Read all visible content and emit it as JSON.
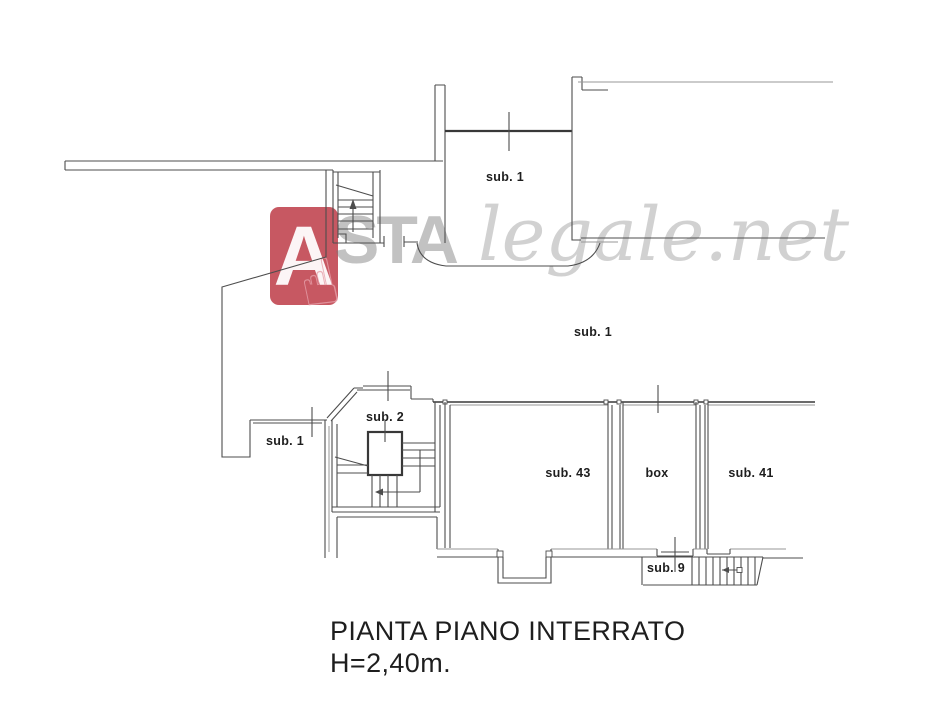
{
  "page": {
    "background": "#ffffff"
  },
  "watermark": {
    "logo_letter": "A",
    "brand_bold": "STA",
    "brand_italic": "legale.net",
    "hand_icon": "☝"
  },
  "rooms": [
    {
      "id": "sub1-top",
      "label": "sub. 1"
    },
    {
      "id": "sub1-middle",
      "label": "sub. 1"
    },
    {
      "id": "sub1-alcove",
      "label": "sub. 1"
    },
    {
      "id": "sub2",
      "label": "sub. 2"
    },
    {
      "id": "sub43",
      "label": "sub. 43"
    },
    {
      "id": "box",
      "label": "box"
    },
    {
      "id": "sub41",
      "label": "sub. 41"
    },
    {
      "id": "sub9",
      "label": "sub. 9"
    }
  ],
  "title": {
    "line1": "PIANTA PIANO INTERRATO",
    "line2": "H=2,40m."
  },
  "css_vars": {
    "line": "#4d4d4d",
    "line-dark": "#383838",
    "line-light": "#979797",
    "ink": "#1e1e1e",
    "wm-red": "rgba(178,24,38,0.72)",
    "wm-gray": "rgba(120,120,120,0.45)",
    "wm-gray-light": "rgba(133,133,133,0.38)",
    "wm-pink": "rgba(230,160,170,0.8)",
    "wm-white": "rgba(255,255,255,0.94)"
  }
}
